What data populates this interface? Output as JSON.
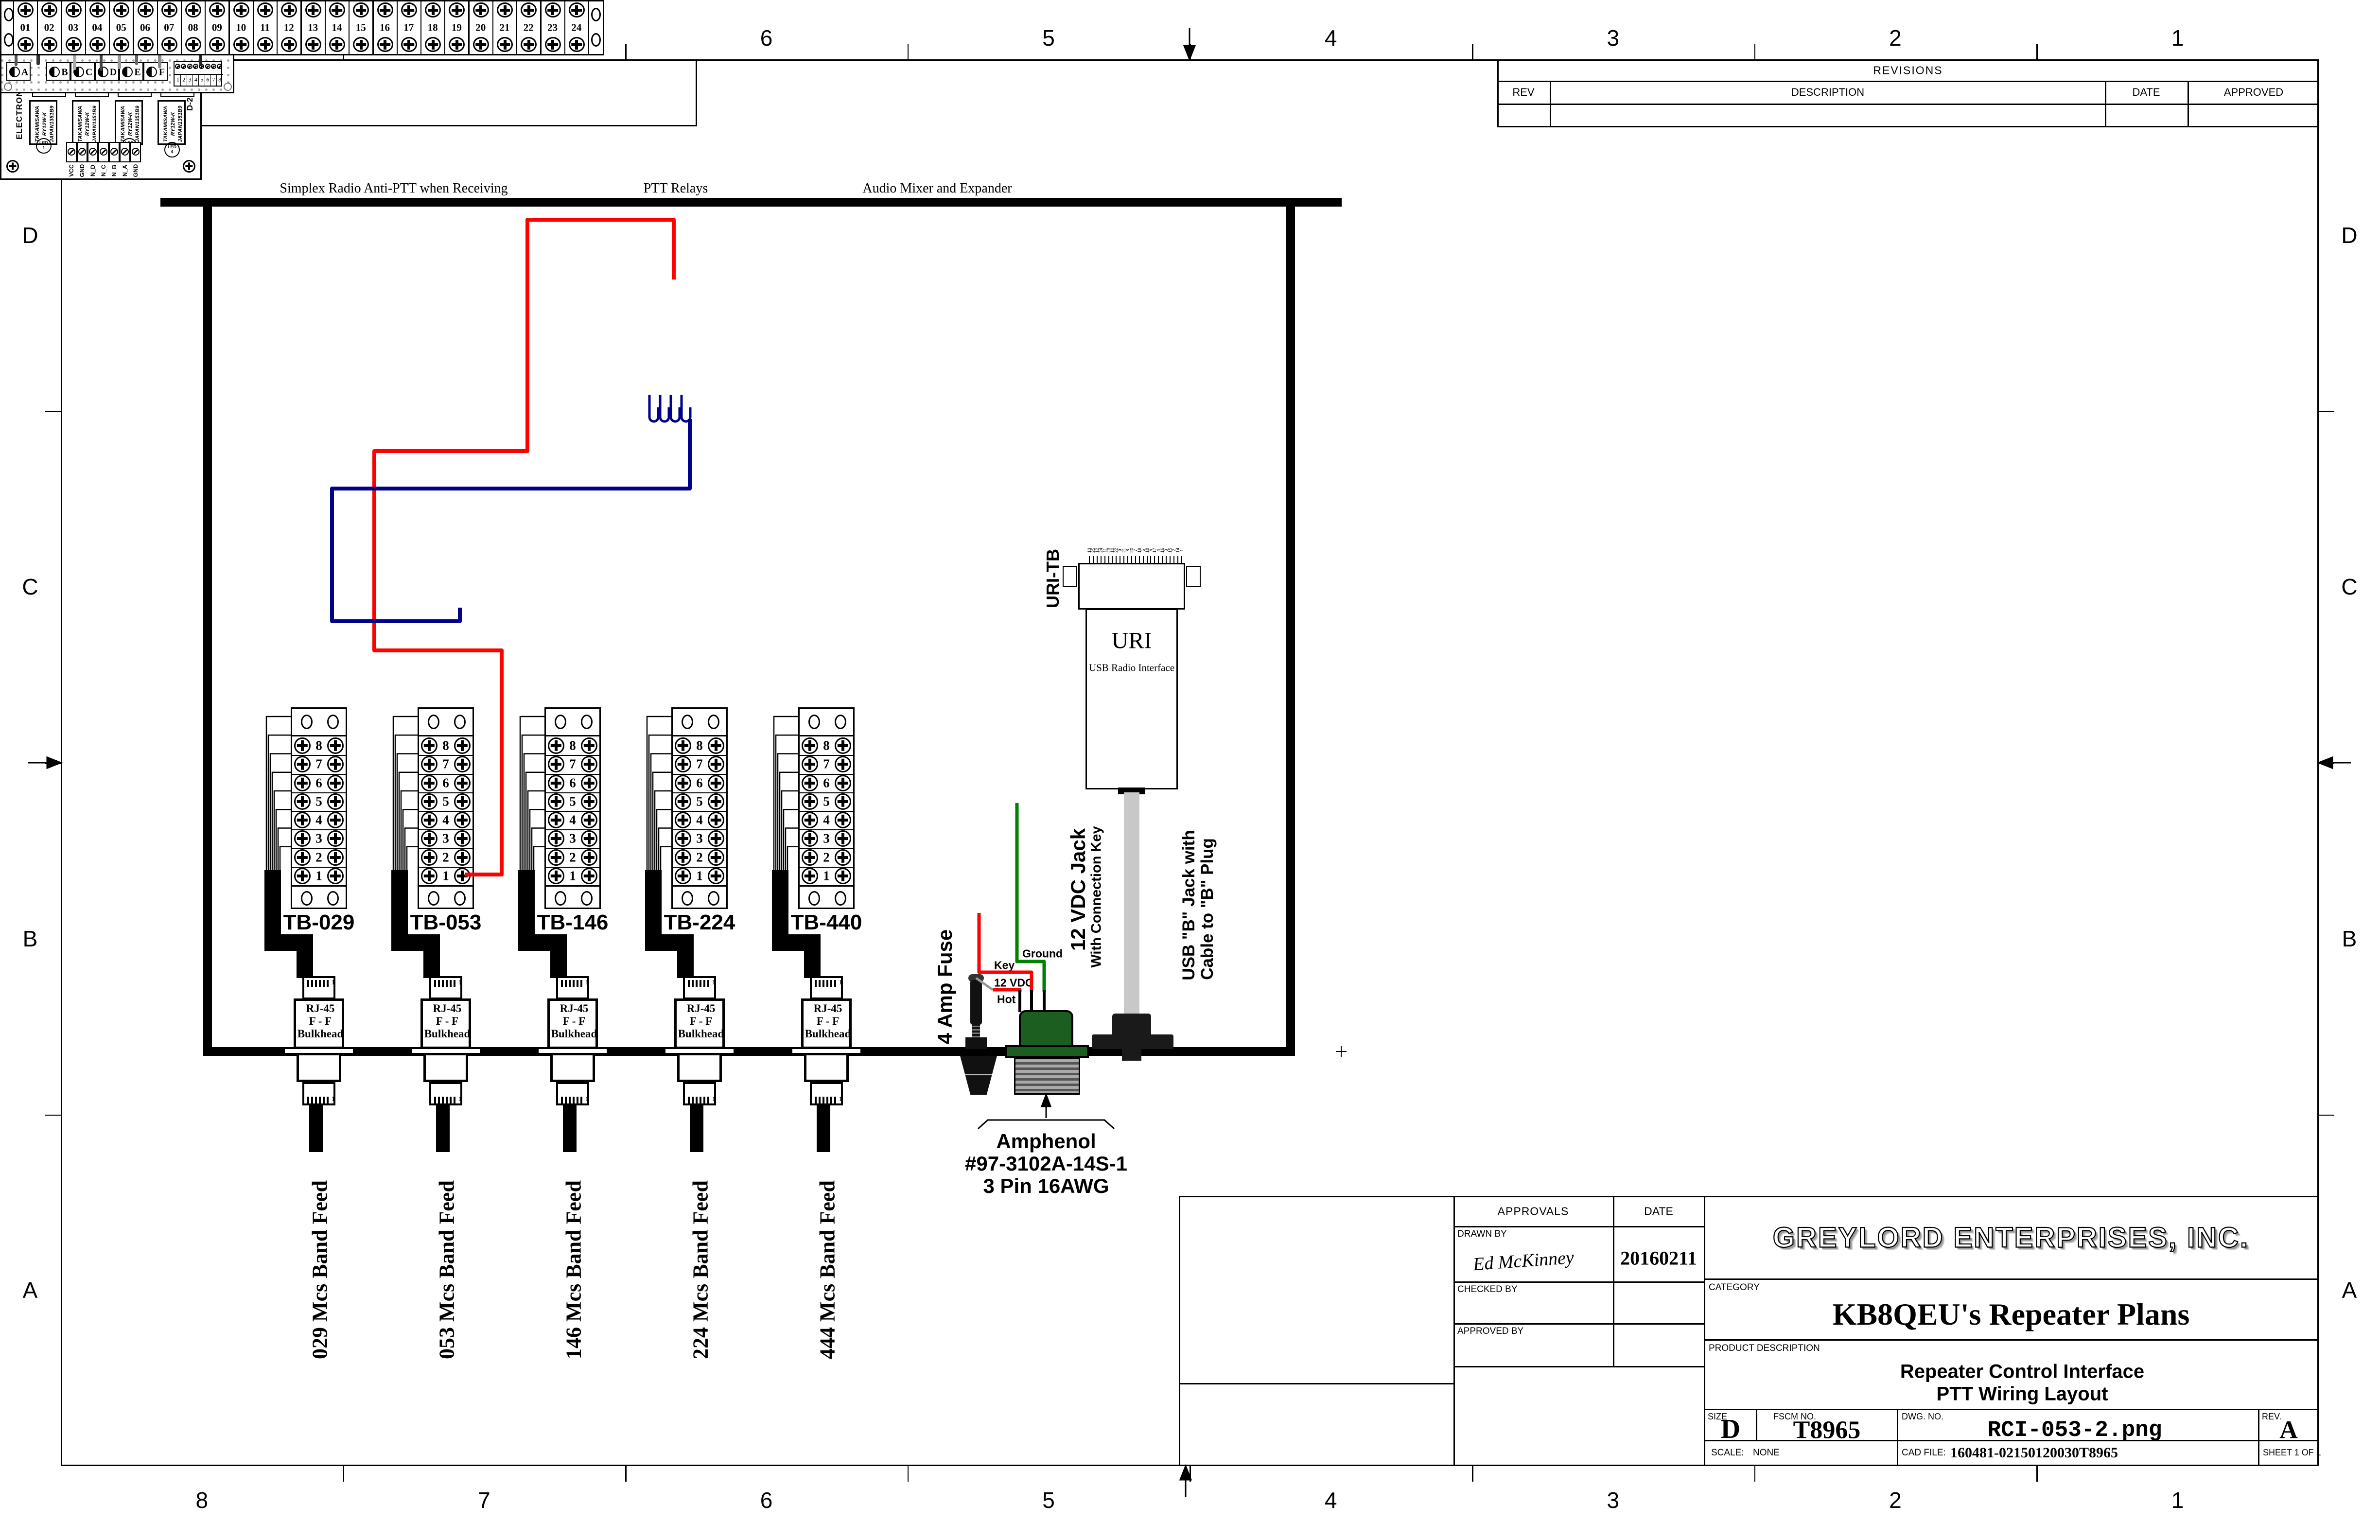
{
  "sheet": {
    "zones_top": [
      "8",
      "7",
      "6",
      "5",
      "4",
      "3",
      "2",
      "1"
    ],
    "zones_bottom": [
      "8",
      "7",
      "6",
      "5",
      "4",
      "3",
      "2",
      "1"
    ],
    "zones_left": [
      "D",
      "C",
      "B",
      "A"
    ],
    "zones_right": [
      "D",
      "C",
      "B",
      "A"
    ]
  },
  "revisions": {
    "title": "REVISIONS",
    "col_rev": "REV",
    "col_description": "DESCRIPTION",
    "col_date": "DATE",
    "col_approved": "APPROVED"
  },
  "captions": {
    "left": "Simplex Radio Anti-PTT when Receiving",
    "middle": "PTT Relays",
    "right": "Audio Mixer and Expander"
  },
  "relay_board": {
    "maker": "ELECTRONICS-SALON",
    "version": "D-256  VER: 1.0",
    "relay_text": [
      "TAKAMISAWA",
      "RY12W-K",
      "JAPAN1351B9"
    ],
    "top_groups": [
      [
        "NC8",
        "C8",
        "NO8"
      ],
      [
        "NC6",
        "C6",
        "NO6"
      ],
      [
        "NC4",
        "C4",
        "NO4"
      ],
      [
        "NC2",
        "C2",
        "NO2"
      ]
    ],
    "mid_groups": [
      [
        "NC7",
        "C7",
        "NO7"
      ],
      [
        "NC5",
        "C5",
        "NO5"
      ],
      [
        "NC3",
        "C3",
        "NO3"
      ],
      [
        "NC1",
        "C1",
        "NO1"
      ]
    ],
    "leds": [
      [
        "LED",
        "1"
      ],
      [
        "LED",
        "2"
      ],
      [
        "LED",
        "3"
      ],
      [
        "LED",
        "4"
      ]
    ],
    "power_terminals": [
      "VCC",
      "GND",
      "N_D",
      "N_C",
      "N_B",
      "N_A",
      "GND"
    ]
  },
  "mixer": {
    "rx": "RX",
    "tx": "TX",
    "rx_pots": [
      "1",
      "2",
      "3",
      "4",
      "5",
      "6"
    ],
    "tx_pots": [
      "A",
      "B",
      "C",
      "D",
      "E",
      "F"
    ],
    "header_pins": [
      "1",
      "2",
      "3",
      "4",
      "5",
      "6",
      "7",
      "8"
    ]
  },
  "uri_tb": {
    "label": "URI-TB",
    "terminals": [
      "01",
      "02",
      "03",
      "04",
      "05",
      "06",
      "07",
      "08",
      "09",
      "10",
      "11",
      "12",
      "13",
      "14",
      "15",
      "16",
      "17",
      "18",
      "19",
      "20",
      "21",
      "22",
      "23",
      "24"
    ]
  },
  "uri": {
    "name": "URI",
    "subtitle": "USB Radio Interface",
    "db25_pins": [
      "13",
      "25",
      "12",
      "24",
      "11",
      "23",
      "10",
      "22",
      "9",
      "21",
      "8",
      "20",
      "7",
      "19",
      "6",
      "18",
      "5",
      "17",
      "4",
      "16",
      "3",
      "15",
      "2",
      "14",
      "1"
    ]
  },
  "feeds": {
    "rj45_lines": [
      "RJ-45",
      "F - F",
      "Bulkhead"
    ],
    "plug_pin": "1",
    "tb_terminals": [
      "8",
      "7",
      "6",
      "5",
      "4",
      "3",
      "2",
      "1"
    ],
    "columns": [
      {
        "tb": "TB-029",
        "feed": "029 Mcs Band Feed"
      },
      {
        "tb": "TB-053",
        "feed": "053 Mcs Band Feed"
      },
      {
        "tb": "TB-146",
        "feed": "146 Mcs Band Feed"
      },
      {
        "tb": "TB-224",
        "feed": "224 Mcs Band Feed"
      },
      {
        "tb": "TB-440",
        "feed": "444 Mcs Band Feed"
      }
    ]
  },
  "power": {
    "fuse_label": "4 Amp Fuse",
    "ground": "Ground",
    "key": "Key",
    "vdc": "12 VDC",
    "hot": "Hot",
    "jack_label_1": "12 VDC Jack",
    "jack_label_2": "With Connection Key",
    "usb_label_1": "USB \"B\" Jack with",
    "usb_label_2": "Cable to \"B\" Plug",
    "amphenol_1": "Amphenol",
    "amphenol_2": "#97-3102A-14S-1",
    "amphenol_3": "3 Pin 16AWG"
  },
  "title_block": {
    "approvals": "APPROVALS",
    "date": "DATE",
    "drawn_by": "DRAWN BY",
    "drawn_sig": "Ed McKinney",
    "drawn_date": "20160211",
    "checked_by": "CHECKED BY",
    "approved_by": "APPROVED BY",
    "company": "GREYLORD ENTERPRISES, INC.",
    "category_label": "CATEGORY",
    "category": "KB8QEU's Repeater Plans",
    "product_label": "PRODUCT DESCRIPTION",
    "product_1": "Repeater Control Interface",
    "product_2": "PTT Wiring Layout",
    "size_label": "SIZE",
    "size": "D",
    "fscm_label": "FSCM NO.",
    "fscm": "T8965",
    "dwg_label": "DWG.  NO.",
    "dwg": "RCI-053-2.png",
    "rev_label": "REV.",
    "rev": "A",
    "scale_label": "SCALE:",
    "scale": "NONE",
    "cad_label": "CAD FILE:",
    "cad": "160481-02150120030T8965",
    "sheet": "SHEET  1  OF  1"
  },
  "colors": {
    "wire_red": "#ff0000",
    "wire_blue": "#00008b",
    "wire_green": "#008000",
    "amphenol_green": "#1c5e20",
    "cable_gray": "#c8c8c8"
  }
}
